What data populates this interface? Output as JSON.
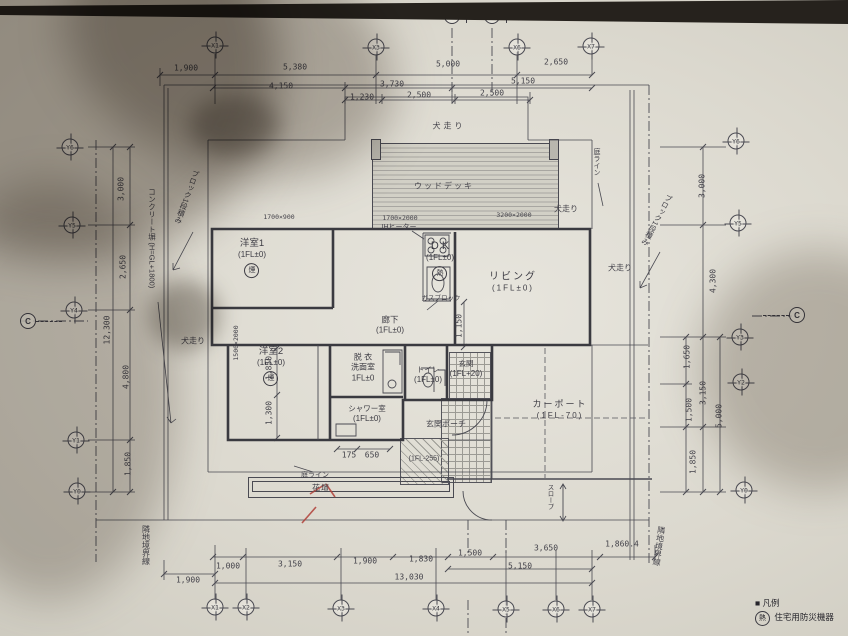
{
  "document": {
    "type": "架構平面図 / 1階平面図 (photographed architectural floor plan)"
  },
  "colors": {
    "paper": "#dcd9cf",
    "line": "#4a4a52",
    "wall": "#3a3a40",
    "red_pen": "#b04038"
  },
  "legend": {
    "bullet": "■",
    "title": "凡例",
    "detector_symbol": "熱",
    "detector_label": "住宅用防災機器"
  },
  "section_markers": [
    {
      "label": "B",
      "x": 452,
      "y": 16,
      "flag": "ra"
    },
    {
      "label": "A",
      "x": 492,
      "y": 16,
      "flag": "ra"
    },
    {
      "label": "C",
      "x": 28,
      "y": 321,
      "flag": "dash-r"
    },
    {
      "label": "C",
      "x": 797,
      "y": 315,
      "flag": "dash-l"
    }
  ],
  "grid_markers": [
    {
      "label": "X1",
      "x": 215,
      "y": 45
    },
    {
      "label": "X3",
      "x": 376,
      "y": 47
    },
    {
      "label": "X6",
      "x": 517,
      "y": 47
    },
    {
      "label": "X7",
      "x": 591,
      "y": 46
    },
    {
      "label": "X1",
      "x": 215,
      "y": 607
    },
    {
      "label": "X2",
      "x": 246,
      "y": 607
    },
    {
      "label": "X3",
      "x": 341,
      "y": 608
    },
    {
      "label": "X4",
      "x": 436,
      "y": 608
    },
    {
      "label": "X5",
      "x": 506,
      "y": 609
    },
    {
      "label": "X6",
      "x": 556,
      "y": 609
    },
    {
      "label": "X7",
      "x": 592,
      "y": 609
    },
    {
      "label": "Y6",
      "x": 70,
      "y": 147
    },
    {
      "label": "Y5",
      "x": 72,
      "y": 225
    },
    {
      "label": "Y4",
      "x": 74,
      "y": 310
    },
    {
      "label": "Y1",
      "x": 76,
      "y": 440
    },
    {
      "label": "Y0",
      "x": 77,
      "y": 491
    },
    {
      "label": "Y6",
      "x": 736,
      "y": 141
    },
    {
      "label": "Y5",
      "x": 738,
      "y": 223
    },
    {
      "label": "Y3",
      "x": 740,
      "y": 337
    },
    {
      "label": "Y2",
      "x": 741,
      "y": 382
    },
    {
      "label": "Y0",
      "x": 744,
      "y": 490
    }
  ],
  "rooms": [
    {
      "lines": [
        "洋室1",
        "(1FL±0)"
      ],
      "detector": "煙",
      "x": 252,
      "y": 258,
      "size": 9.5
    },
    {
      "lines": [
        "D K",
        "(1FL±0)"
      ],
      "detector": "熱",
      "x": 440,
      "y": 260,
      "size": 11
    },
    {
      "lines": [
        "リビング",
        "(1FL±0)"
      ],
      "x": 513,
      "y": 282,
      "size": 10,
      "ls": 2
    },
    {
      "lines": [
        "廊下",
        "(1FL±0)"
      ],
      "x": 390,
      "y": 325,
      "size": 8.5
    },
    {
      "lines": [
        "洋室2",
        "(1FL±0)"
      ],
      "detector": "煙",
      "x": 271,
      "y": 366,
      "size": 9.5
    },
    {
      "lines": [
        "脱 衣",
        "洗面室",
        "1FL±0"
      ],
      "x": 363,
      "y": 368,
      "size": 8
    },
    {
      "lines": [
        "シャワー室",
        "(1FL±0)"
      ],
      "x": 367,
      "y": 414,
      "size": 7.5
    },
    {
      "lines": [
        "トイレ",
        "(1FL±0)"
      ],
      "x": 428,
      "y": 375,
      "size": 7.5
    },
    {
      "lines": [
        "玄関",
        "(1FL+20)"
      ],
      "x": 466,
      "y": 369,
      "size": 7.5
    },
    {
      "lines": [
        "カーポート",
        "(1FL-70)"
      ],
      "x": 560,
      "y": 410,
      "size": 9,
      "ls": 2
    }
  ],
  "dimensions": [
    {
      "text": "1,900",
      "x": 186,
      "y": 68
    },
    {
      "text": "5,380",
      "x": 295,
      "y": 67
    },
    {
      "text": "5,000",
      "x": 448,
      "y": 64
    },
    {
      "text": "2,650",
      "x": 556,
      "y": 62
    },
    {
      "text": "4,150",
      "x": 281,
      "y": 86
    },
    {
      "text": "3,730",
      "x": 392,
      "y": 84
    },
    {
      "text": "5,150",
      "x": 523,
      "y": 81
    },
    {
      "text": "1,230",
      "x": 362,
      "y": 97
    },
    {
      "text": "2,500",
      "x": 419,
      "y": 95
    },
    {
      "text": "2,500",
      "x": 492,
      "y": 93
    },
    {
      "text": "1,000",
      "x": 228,
      "y": 566
    },
    {
      "text": "3,150",
      "x": 290,
      "y": 564
    },
    {
      "text": "1,900",
      "x": 365,
      "y": 561
    },
    {
      "text": "1,830",
      "x": 421,
      "y": 559
    },
    {
      "text": "1,500",
      "x": 470,
      "y": 553
    },
    {
      "text": "3,650",
      "x": 546,
      "y": 548
    },
    {
      "text": "1,860.4",
      "x": 622,
      "y": 544
    },
    {
      "text": "5,150",
      "x": 520,
      "y": 566
    },
    {
      "text": "13,030",
      "x": 409,
      "y": 577
    },
    {
      "text": "1,900",
      "x": 188,
      "y": 580
    },
    {
      "text": "3,000",
      "x": 121,
      "y": 189,
      "rot": -90
    },
    {
      "text": "2,650",
      "x": 123,
      "y": 267,
      "rot": -90
    },
    {
      "text": "4,800",
      "x": 126,
      "y": 377,
      "rot": -90
    },
    {
      "text": "1,850",
      "x": 128,
      "y": 464,
      "rot": -90
    },
    {
      "text": "12,300",
      "x": 107,
      "y": 330,
      "rot": -90
    },
    {
      "text": "3,000",
      "x": 702,
      "y": 186,
      "rot": -90
    },
    {
      "text": "4,300",
      "x": 713,
      "y": 281,
      "rot": -90
    },
    {
      "text": "1,650",
      "x": 687,
      "y": 357,
      "rot": -90
    },
    {
      "text": "1,500",
      "x": 689,
      "y": 410,
      "rot": -90
    },
    {
      "text": "3,150",
      "x": 703,
      "y": 393,
      "rot": -90
    },
    {
      "text": "5,000",
      "x": 719,
      "y": 416,
      "rot": -90
    },
    {
      "text": "1,850",
      "x": 693,
      "y": 462,
      "rot": -90
    },
    {
      "text": "1,150",
      "x": 459,
      "y": 326,
      "rot": -90
    },
    {
      "text": "1,850",
      "x": 269,
      "y": 368,
      "rot": -90
    },
    {
      "text": "1,300",
      "x": 269,
      "y": 413,
      "rot": -90
    },
    {
      "text": "175",
      "x": 349,
      "y": 455
    },
    {
      "text": "650",
      "x": 372,
      "y": 455
    },
    {
      "text": "1700×900",
      "x": 279,
      "y": 217,
      "size": 6.5
    },
    {
      "text": "1700×2000",
      "x": 400,
      "y": 218,
      "size": 6.5
    },
    {
      "text": "3200×2000",
      "x": 514,
      "y": 215,
      "size": 6.5
    },
    {
      "text": "1500×2000",
      "x": 236,
      "y": 343,
      "rot": -90,
      "size": 6.5
    }
  ],
  "labels": [
    {
      "text": "犬走り",
      "x": 449,
      "y": 126,
      "ls": 3
    },
    {
      "text": "犬走り",
      "x": 566,
      "y": 209
    },
    {
      "text": "犬走り",
      "x": 620,
      "y": 268
    },
    {
      "text": "犬走り",
      "x": 193,
      "y": 341
    },
    {
      "text": "ウッドデッキ",
      "x": 444,
      "y": 186,
      "ls": 2
    },
    {
      "text": "IHヒーター",
      "x": 399,
      "y": 227,
      "size": 7
    },
    {
      "text": "ガスブロック",
      "x": 441,
      "y": 297,
      "size": 6.5
    },
    {
      "text": "コンクリート塀 (H=GL+1800)",
      "x": 152,
      "y": 238,
      "vert": true,
      "size": 7.5
    },
    {
      "text": "ブロック1段積み",
      "x": 187,
      "y": 197,
      "vert": true,
      "rot": 20,
      "size": 7.5
    },
    {
      "text": "ブロック1段積み",
      "x": 657,
      "y": 220,
      "vert": true,
      "rot": 28,
      "size": 7.5
    },
    {
      "text": "庭ライン",
      "x": 596,
      "y": 162,
      "vert": true,
      "size": 7
    },
    {
      "text": "庭ライン",
      "x": 315,
      "y": 475,
      "size": 7
    },
    {
      "text": "花壇",
      "x": 321,
      "y": 488,
      "size": 8,
      "ls": 1
    },
    {
      "text": "スロープ",
      "x": 549,
      "y": 497,
      "vert": true,
      "size": 6.5
    },
    {
      "text": "隣地境界線",
      "x": 146,
      "y": 545,
      "vert": true,
      "size": 8
    },
    {
      "text": "隣地境界線",
      "x": 659,
      "y": 546,
      "vert": true,
      "rot": 8,
      "size": 8
    },
    {
      "text": "玄関ポーチ",
      "x": 446,
      "y": 424,
      "size": 8
    },
    {
      "text": "(1FL-255)",
      "x": 424,
      "y": 459,
      "size": 7
    }
  ]
}
